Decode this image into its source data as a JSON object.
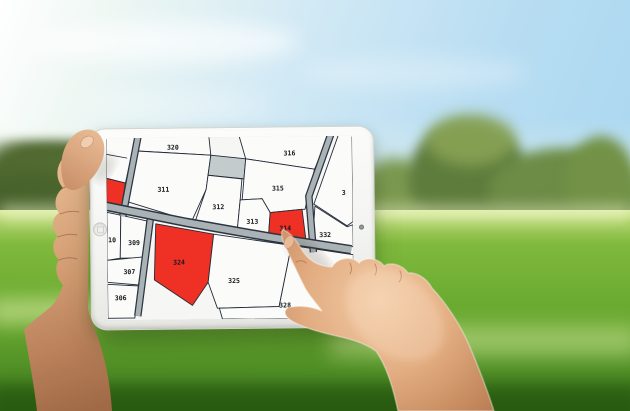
{
  "map": {
    "parcels": [
      {
        "label": "320",
        "highlighted": false
      },
      {
        "label": "316",
        "highlighted": false
      },
      {
        "label": "311",
        "highlighted": false
      },
      {
        "label": "315",
        "highlighted": false
      },
      {
        "label": "312",
        "highlighted": false
      },
      {
        "label": "313",
        "highlighted": false
      },
      {
        "label": "314",
        "highlighted": true
      },
      {
        "label": "332",
        "highlighted": false
      },
      {
        "label": "3",
        "highlighted": false
      },
      {
        "label": "10",
        "highlighted": false
      },
      {
        "label": "309",
        "highlighted": false
      },
      {
        "label": "307",
        "highlighted": false
      },
      {
        "label": "306",
        "highlighted": false
      },
      {
        "label": "324",
        "highlighted": true
      },
      {
        "label": "325",
        "highlighted": false
      },
      {
        "label": "328",
        "highlighted": false
      }
    ],
    "colors": {
      "highlight": "#ee3124",
      "parcel_fill": "#fbfbfa",
      "boundary_line": "#232b38",
      "road_fill": "#a9b2b5",
      "road_edge": "#2b3440",
      "unnumbered_parcel": "#c4cbcd",
      "label_color": "#15181d"
    }
  },
  "tablet": {
    "body_color": "#f2f2f0",
    "home_button_icon": "circle",
    "front_camera_icon": "dot"
  }
}
